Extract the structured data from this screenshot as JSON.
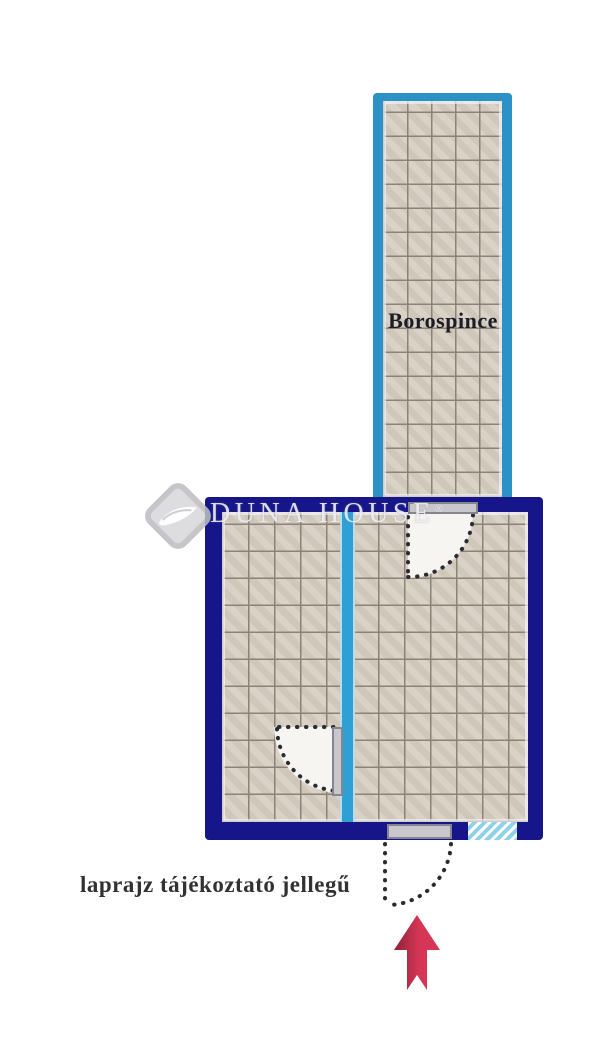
{
  "title": "floor plan",
  "rooms": {
    "corridor": {
      "label": "Borospince"
    }
  },
  "watermark": {
    "brand": "DUNA HOUSE",
    "registered": "®"
  },
  "note": {
    "text": "laprajz tájékoztató jellegű"
  },
  "icons": {
    "logo": "duna-house-diamond-logo",
    "entrance_arrow": "entrance-up-arrow"
  },
  "colors": {
    "wall_navy": "#16168a",
    "wall_cyan": "#2b91c6",
    "divider_cyan": "#2fa0d4",
    "divider_halo": "#bcdcec",
    "tile_base": "#d6cdc1",
    "tile_grout": "#8c8276",
    "door_fill": "#c8c8cc",
    "door_border": "#85858d",
    "swing_fill": "#f6f5f1",
    "dot_color": "#2b2b33",
    "hatch_blue": "#8fd0ea",
    "arrow_red": "#d63656",
    "arrow_red_dark": "#8e2138",
    "watermark_gray": "#ededf2",
    "label_dark": "#1c1c26",
    "note_dark": "#323232"
  }
}
